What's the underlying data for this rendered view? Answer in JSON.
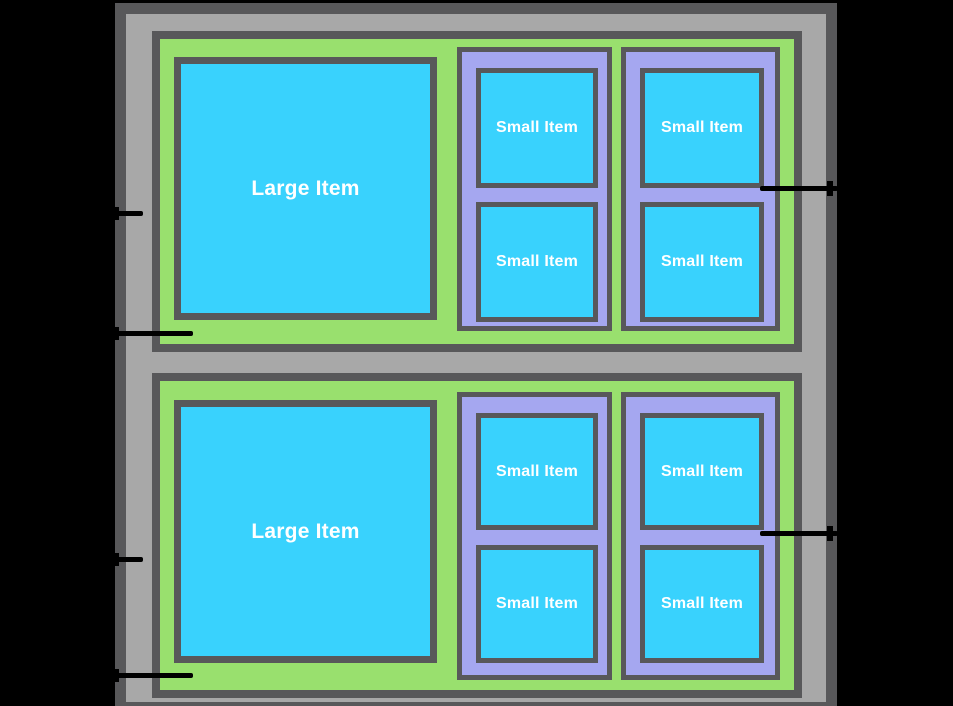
{
  "colors": {
    "background": "#000000",
    "frame_border": "#58585a",
    "frame_fill": "#a8a8a8",
    "panel_fill": "#99e06e",
    "column_fill": "#a5a7f0",
    "item_fill": "#39d2fd",
    "item_text": "#ffffff",
    "annotation": "#000000"
  },
  "panels": [
    {
      "large_item": {
        "label": "Large Item"
      },
      "columns": [
        {
          "items": [
            {
              "label": "Small Item"
            },
            {
              "label": "Small Item"
            }
          ]
        },
        {
          "items": [
            {
              "label": "Small Item"
            },
            {
              "label": "Small Item"
            }
          ]
        }
      ]
    },
    {
      "large_item": {
        "label": "Large Item"
      },
      "columns": [
        {
          "items": [
            {
              "label": "Small Item"
            },
            {
              "label": "Small Item"
            }
          ]
        },
        {
          "items": [
            {
              "label": "Small Item"
            },
            {
              "label": "Small Item"
            }
          ]
        }
      ]
    }
  ]
}
